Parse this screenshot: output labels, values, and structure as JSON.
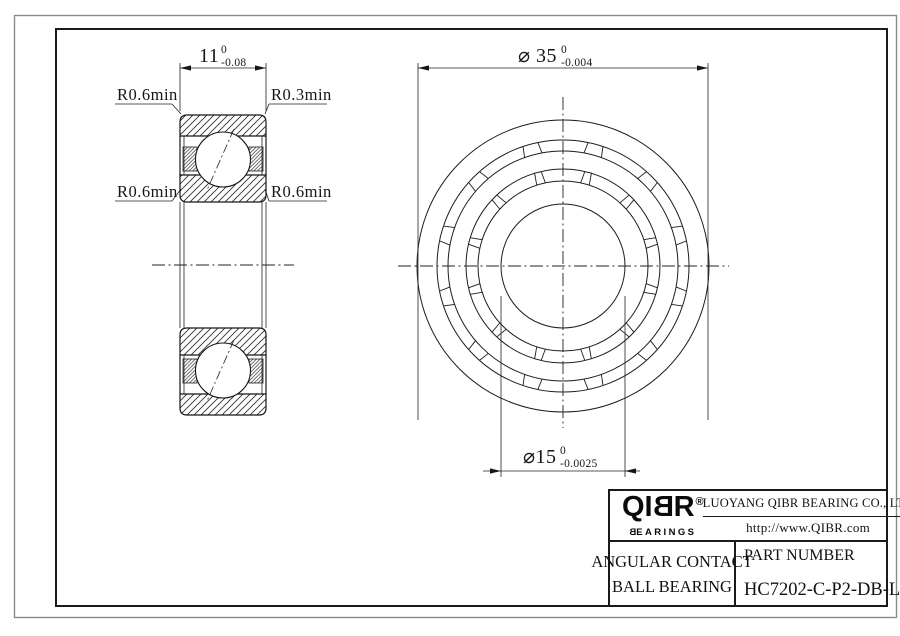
{
  "colors": {
    "line": "#1a1a1a",
    "outer_frame": "#8a8a8a",
    "background": "#ffffff"
  },
  "section_view": {
    "width_dim": {
      "value": "11",
      "tol_upper": "0",
      "tol_lower": "-0.08"
    },
    "corner_labels": {
      "top_left": "R0.6min",
      "top_right": "R0.3min",
      "mid_left": "R0.6min",
      "mid_right": "R0.6min"
    }
  },
  "front_view": {
    "od_dim": {
      "text": "⌀ 35",
      "tol_upper": "0",
      "tol_lower": "-0.004"
    },
    "bore_dim": {
      "text": "⌀15",
      "tol_upper": "0",
      "tol_lower": "-0.0025"
    }
  },
  "title_block": {
    "logo": {
      "part1": "QI",
      "part_b": "B",
      "part2": "R",
      "registered": "®",
      "sub_b": "B",
      "sub_rest": "EARINGS"
    },
    "company_name": "LUOYANG QIBR BEARING CO., LTD",
    "website": "http://www.QIBR.com",
    "product_type_line1": "ANGULAR CONTACT",
    "product_type_line2": "BALL BEARING",
    "part_number_label": "PART NUMBER",
    "part_number": "HC7202-C-P2-DB-L"
  }
}
